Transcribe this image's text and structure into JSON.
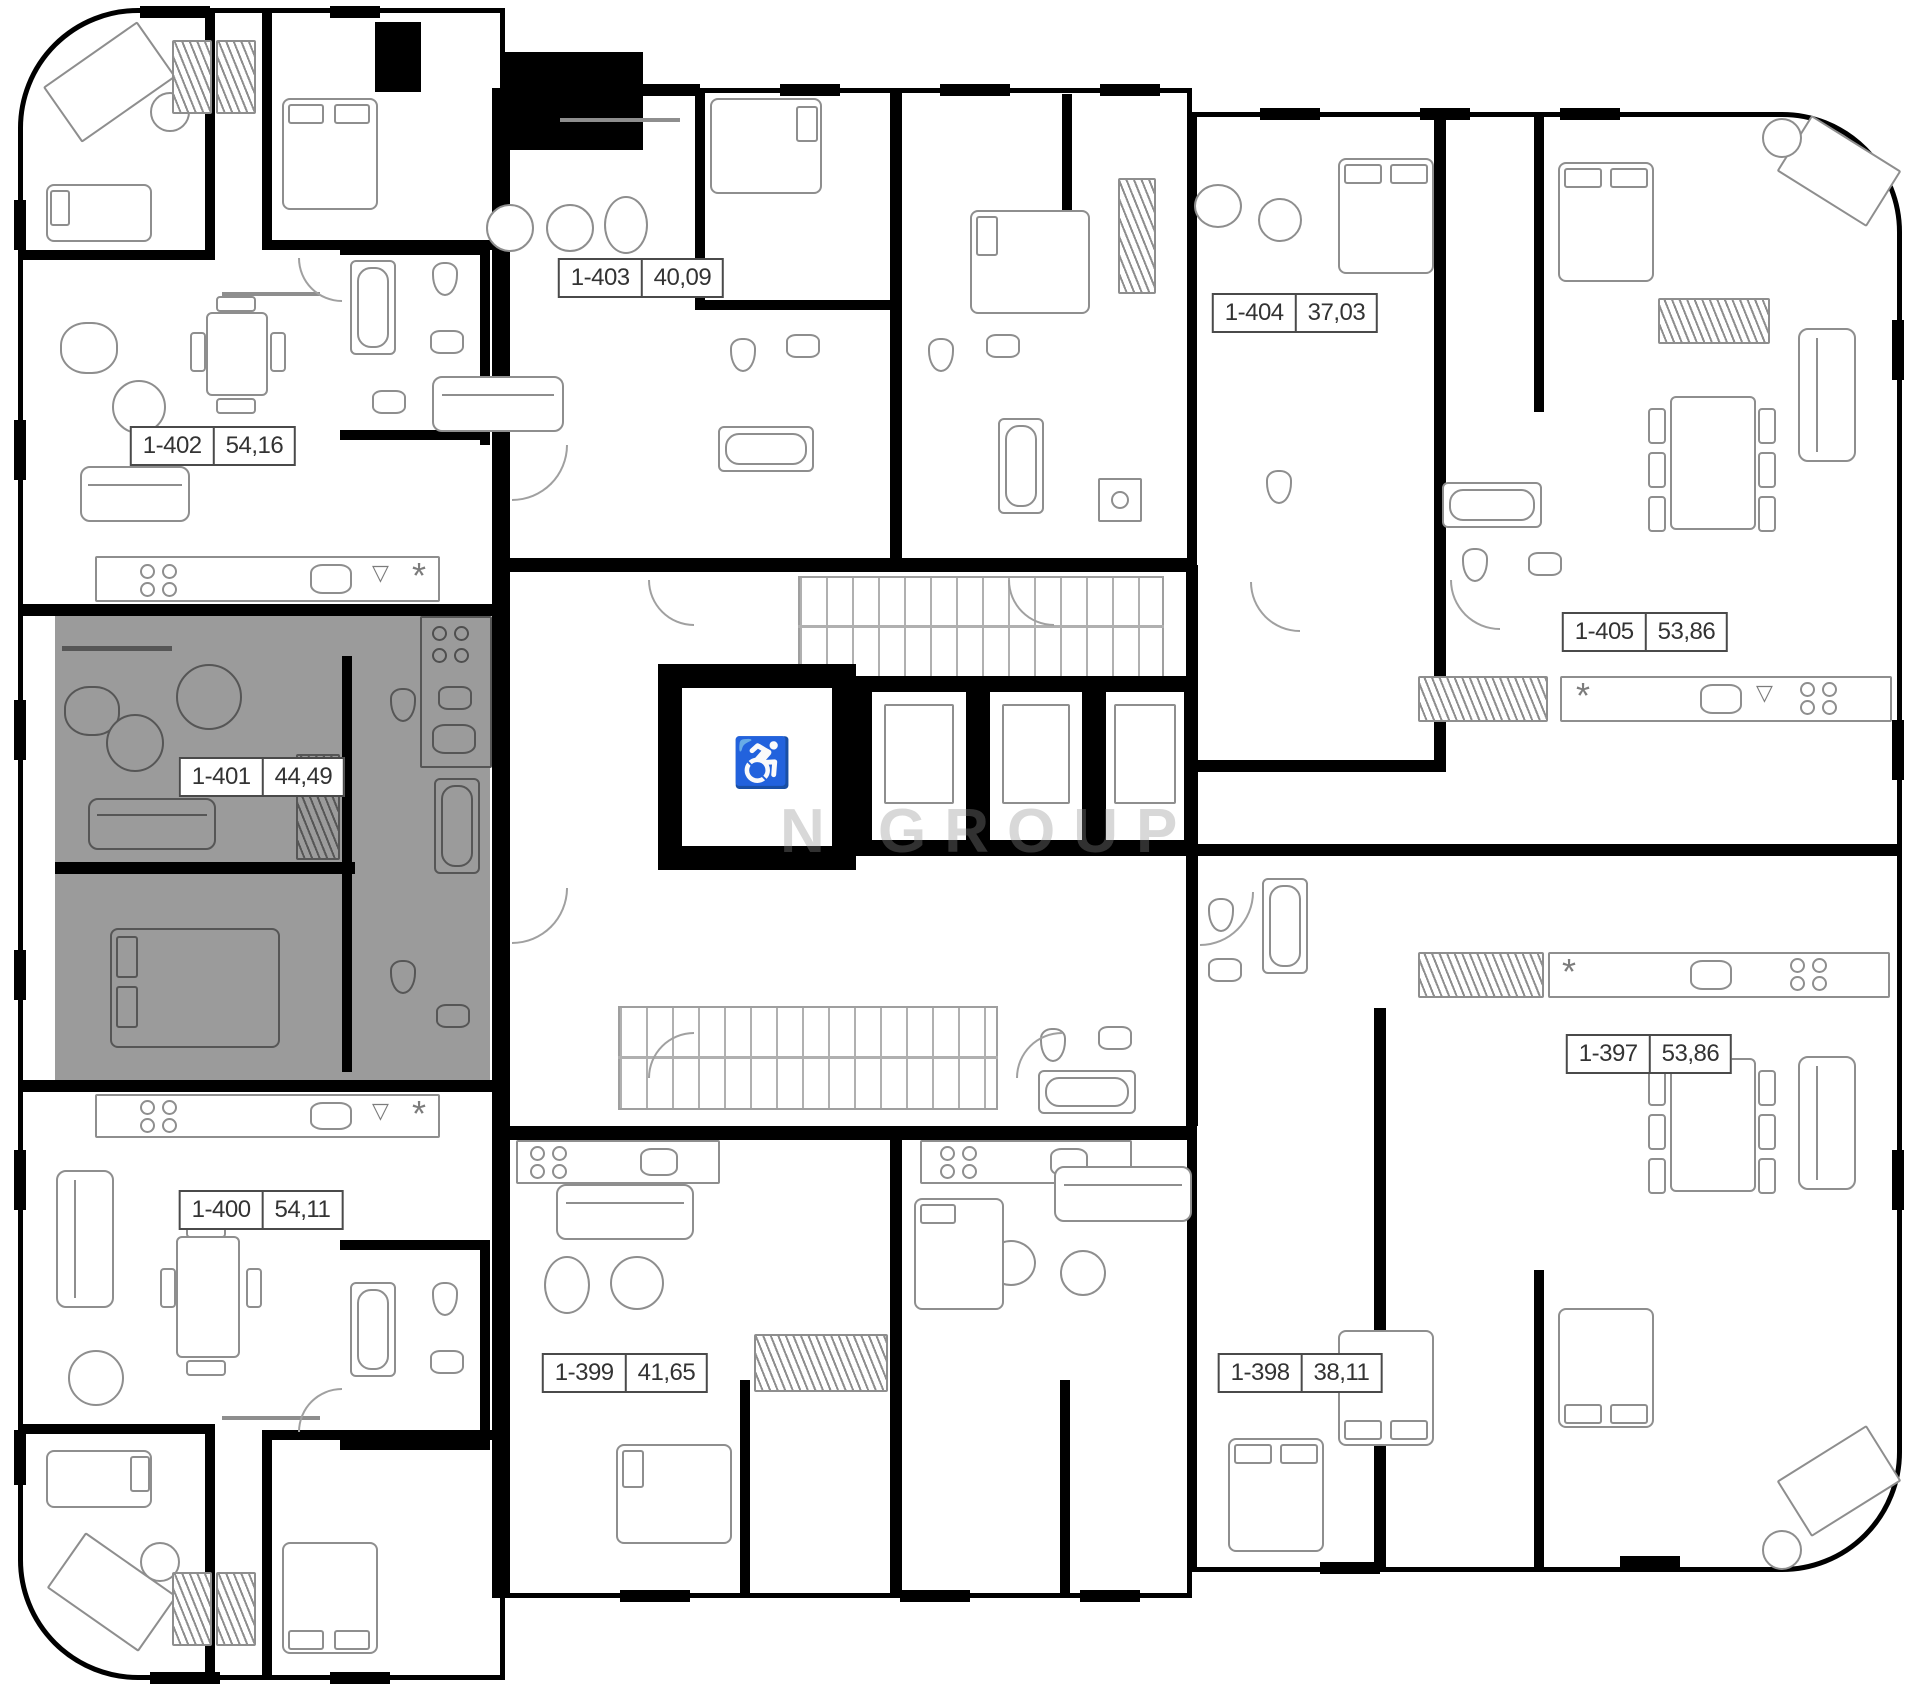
{
  "watermark": {
    "text": "N GROUP"
  },
  "units": [
    {
      "id": "1-402",
      "area": "54,16",
      "highlighted": false
    },
    {
      "id": "1-403",
      "area": "40,09",
      "highlighted": false
    },
    {
      "id": "1-404",
      "area": "37,03",
      "highlighted": false
    },
    {
      "id": "1-405",
      "area": "53,86",
      "highlighted": false
    },
    {
      "id": "1-401",
      "area": "44,49",
      "highlighted": true
    },
    {
      "id": "1-400",
      "area": "54,11",
      "highlighted": false
    },
    {
      "id": "1-399",
      "area": "41,65",
      "highlighted": false
    },
    {
      "id": "1-398",
      "area": "38,11",
      "highlighted": false
    },
    {
      "id": "1-397",
      "area": "53,86",
      "highlighted": false
    }
  ],
  "colors": {
    "highlight_fill": "#9b9b9b",
    "wall": "#000000",
    "furniture_line": "#8e8e8e",
    "label_border": "#4a4a4a",
    "label_text": "#333333"
  }
}
